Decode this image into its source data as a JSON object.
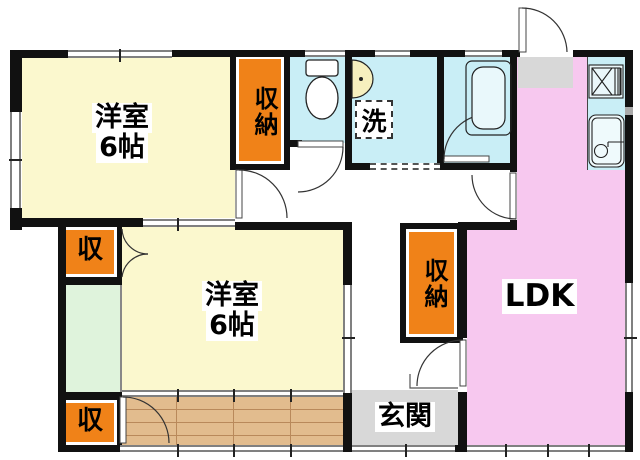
{
  "rooms": {
    "bedroom1": {
      "name": "洋室",
      "size": "6帖"
    },
    "bedroom2": {
      "name": "洋室",
      "size": "6帖"
    },
    "ldk": {
      "label": "LDK"
    },
    "entrance": {
      "label": "玄関"
    },
    "laundry": {
      "label": "洗"
    },
    "closet_tall_1": {
      "label": "収納"
    },
    "closet_tall_2": {
      "label": "収納"
    },
    "closet_small_1": {
      "label": "収"
    },
    "closet_small_2": {
      "label": "収"
    }
  },
  "colors": {
    "wall": "#111111",
    "bedroom": "#FBF8CE",
    "water": "#C9EEF6",
    "ldk": "#F7C8EF",
    "closet": "#F08218",
    "alcove": "#DFF3DC",
    "entry": "#D8D8D8",
    "wood": "#E2BC8E",
    "woodline": "#B9895B",
    "winline": "#808080",
    "fixture_cream": "#F6EFBE"
  }
}
